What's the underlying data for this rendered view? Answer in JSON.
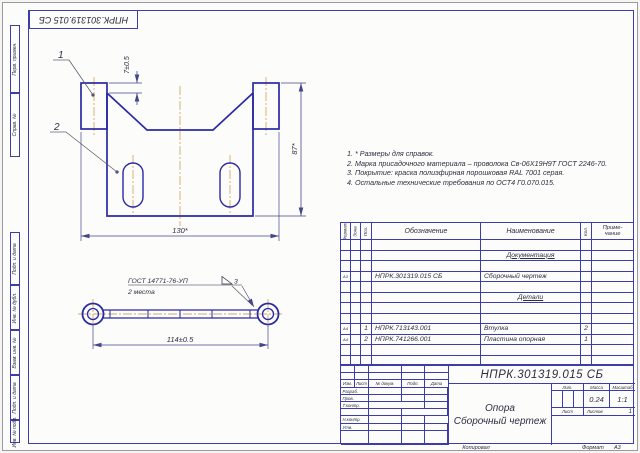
{
  "frame": {
    "rotated_designation": "НПРК.301319.015 СБ",
    "margin_top": [
      "Перв. примен.",
      "Справ. №"
    ],
    "margin_bottom": [
      "Подп. и дата",
      "Инв. № дубл.",
      "Взам. инв. №",
      "Подп. и дата",
      "Инв. № подл."
    ],
    "copied": "Копировал",
    "format_label": "Формат",
    "format_value": "А3"
  },
  "drawing": {
    "callout_1": "1",
    "callout_2": "2",
    "dim_gap": "7±0.5",
    "dim_height": "87*",
    "dim_width": "130*",
    "dim_length": "114±0.5",
    "weld_gost": "ГОСТ 14771-76-УП",
    "weld_size": "3",
    "weld_places": "2 места"
  },
  "tech_requirements": [
    "1.  * Размеры для справок.",
    "2.  Марка присадочного материала – проволока Св-06Х19Н9Т ГОСТ 2246-70.",
    "3.  Покрытие: краска полиэфирная порошковая  RAL 7001 серая.",
    "4.  Остальные технические требования по ОСТ4 Г0.070.015."
  ],
  "spec": {
    "headers": {
      "format": "Формат",
      "zone": "Зона",
      "pos": "Поз.",
      "designation": "Обозначение",
      "name": "Наименование",
      "qty": "Кол.",
      "note_1": "Приме-",
      "note_2": "чание"
    },
    "rows": [
      {},
      {
        "name": "Документация",
        "section": true
      },
      {},
      {
        "format": "А3",
        "designation": "НПРК.301319.015 СБ",
        "name": "Сборочный чертеж"
      },
      {},
      {
        "name": "Детали",
        "section": true
      },
      {},
      {},
      {
        "format": "А4",
        "pos": "1",
        "designation": "НПРК.713143.001",
        "name": "Втулка",
        "qty": "2"
      },
      {
        "format": "А4",
        "pos": "2",
        "designation": "НПРК.741266.001",
        "name": "Пластина опорная",
        "qty": "1"
      },
      {},
      {}
    ]
  },
  "title_block": {
    "designation": "НПРК.301319.015 СБ",
    "product_name": "Опора",
    "doc_type": "Сборочный чертеж",
    "col_headers": [
      "Изм.",
      "Лист",
      "№ докум.",
      "Подп.",
      "Дата"
    ],
    "role_rows": [
      "Разраб.",
      "Пров.",
      "Т.контр.",
      "Н.контр.",
      "Утв."
    ],
    "lit_label": "Лит.",
    "mass_label": "Масса",
    "scale_label": "Масштаб",
    "mass_value": "0.24",
    "scale_value": "1:1",
    "sheet_label": "Лист",
    "sheets_label": "Листов",
    "sheets_value": "1"
  }
}
